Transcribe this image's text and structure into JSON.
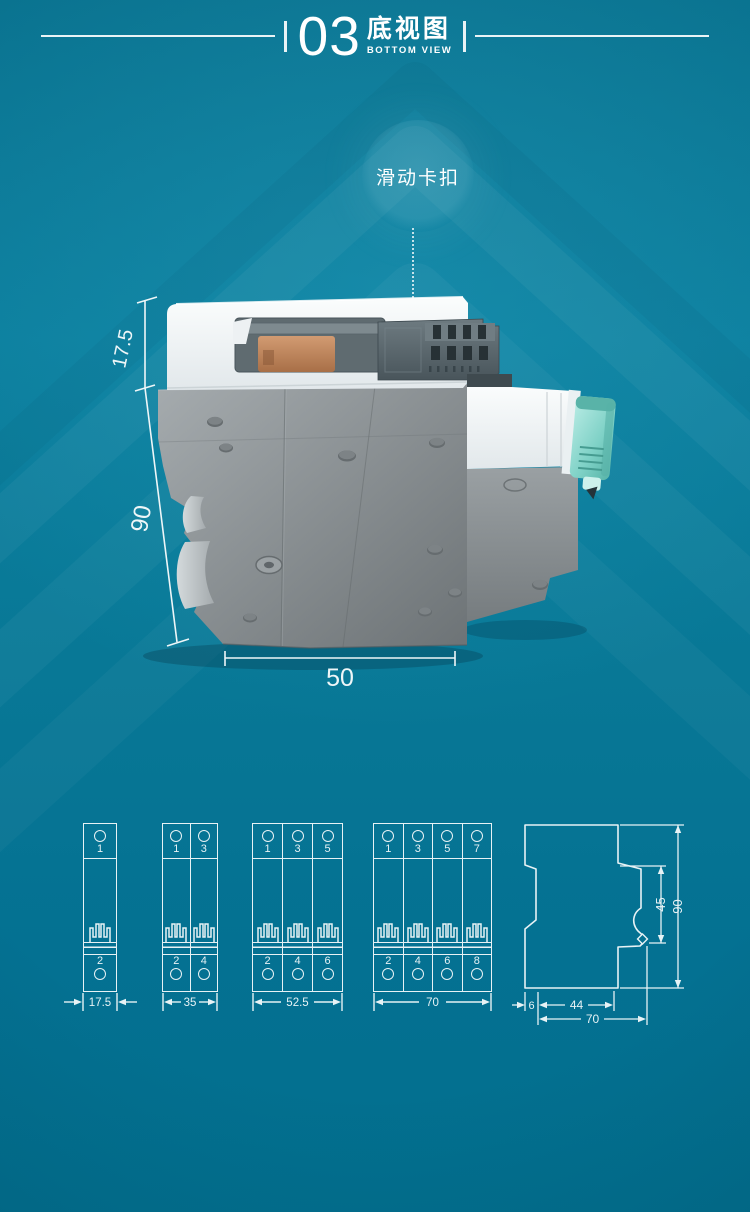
{
  "header": {
    "number": "03",
    "title_cn": "底视图",
    "title_en": "BOTTOM VIEW"
  },
  "callout": {
    "label": "滑动卡扣"
  },
  "photo": {
    "dim_top": "17.5",
    "dim_side": "90",
    "dim_bottom": "50"
  },
  "drawings": {
    "units": [
      {
        "width_label": "17.5",
        "poles": [
          {
            "top": "1",
            "bottom": "2"
          }
        ]
      },
      {
        "width_label": "35",
        "poles": [
          {
            "top": "1",
            "bottom": "2"
          },
          {
            "top": "3",
            "bottom": "4"
          }
        ]
      },
      {
        "width_label": "52.5",
        "poles": [
          {
            "top": "1",
            "bottom": "2"
          },
          {
            "top": "3",
            "bottom": "4"
          },
          {
            "top": "5",
            "bottom": "6"
          }
        ]
      },
      {
        "width_label": "70",
        "poles": [
          {
            "top": "1",
            "bottom": "2"
          },
          {
            "top": "3",
            "bottom": "4"
          },
          {
            "top": "5",
            "bottom": "6"
          },
          {
            "top": "7",
            "bottom": "8"
          }
        ]
      }
    ],
    "profile": {
      "height_upper": "45",
      "height_total": "90",
      "depth_back": "6",
      "depth_body": "44",
      "depth_total": "70"
    }
  },
  "colors": {
    "background": "#0c7f9e",
    "line": "#e7f2f5",
    "body_white": "#f3f6f7",
    "body_gray": "#8b9194",
    "slider_gray": "#5c6970",
    "clip_mint": "#86d5cb",
    "copper": "#c58e66"
  }
}
